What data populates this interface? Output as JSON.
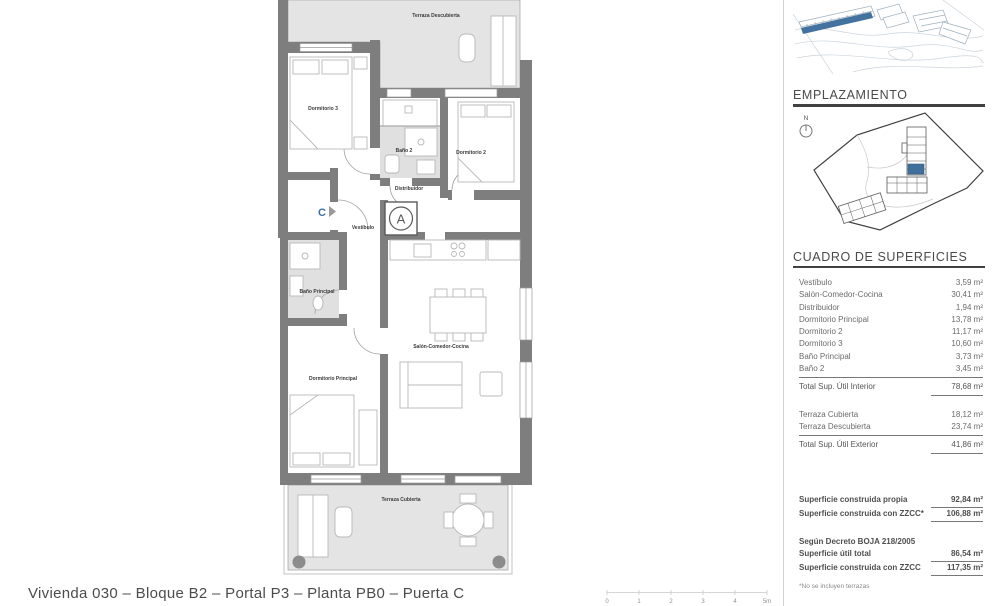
{
  "footer": {
    "title": "Vivienda 030 – Bloque B2 – Portal P3 – Planta PB0 – Puerta C",
    "scale_labels": [
      "0",
      "1",
      "2",
      "3",
      "4",
      "5m"
    ]
  },
  "plan": {
    "entrance_letter": "C",
    "shaft_letter": "A",
    "rooms": {
      "terraza_descubierta": "Terraza Descubierta",
      "dormitorio_3": "Dormitorio 3",
      "bano_2": "Baño 2",
      "dormitorio_2": "Dormitorio 2",
      "distribuidor": "Distribuidor",
      "vestibulo": "Vestíbulo",
      "bano_principal": "Baño Principal",
      "dormitorio_principal": "Dormitorio Principal",
      "salon": "Salón-Comedor-Cocina",
      "terraza_cubierta": "Terraza Cubierta"
    }
  },
  "sidebar": {
    "emplazamiento_title": "EMPLAZAMIENTO",
    "north_label": "N",
    "superficies_title": "CUADRO DE SUPERFICIES",
    "interior_rows": [
      {
        "label": "Vestíbulo",
        "value": "3,59 m²"
      },
      {
        "label": "Salón-Comedor-Cocina",
        "value": "30,41 m²"
      },
      {
        "label": "Distribuidor",
        "value": "1,94 m²"
      },
      {
        "label": "Dormitorio Principal",
        "value": "13,78 m²"
      },
      {
        "label": "Dormitorio 2",
        "value": "11,17 m²"
      },
      {
        "label": "Dormitorio 3",
        "value": "10,60 m²"
      },
      {
        "label": "Baño Principal",
        "value": "3,73 m²"
      },
      {
        "label": "Baño 2",
        "value": "3,45 m²"
      }
    ],
    "interior_total": {
      "label": "Total Sup. Útil Interior",
      "value": "78,68 m²"
    },
    "exterior_rows": [
      {
        "label": "Terraza Cubierta",
        "value": "18,12 m²"
      },
      {
        "label": "Terraza Descubierta",
        "value": "23,74 m²"
      }
    ],
    "exterior_total": {
      "label": "Total Sup. Útil Exterior",
      "value": "41,86 m²"
    },
    "construida_rows": [
      {
        "label": "Superficie construida propia",
        "value": "92,84 m²"
      },
      {
        "label": "Superficie construida con ZZCC*",
        "value": "106,88 m²"
      }
    ],
    "decreto_heading": "Según Decreto BOJA 218/2005",
    "decreto_rows": [
      {
        "label": "Superficie útil total",
        "value": "86,54 m²"
      },
      {
        "label": "Superficie construida con ZZCC",
        "value": "117,35 m²"
      }
    ],
    "footnote": "*No se incluyen terrazas"
  },
  "colors": {
    "accent_blue": "#3e6ea8",
    "wall_gray": "#7e7e7e",
    "terrace_gray": "#e4e4e4"
  }
}
